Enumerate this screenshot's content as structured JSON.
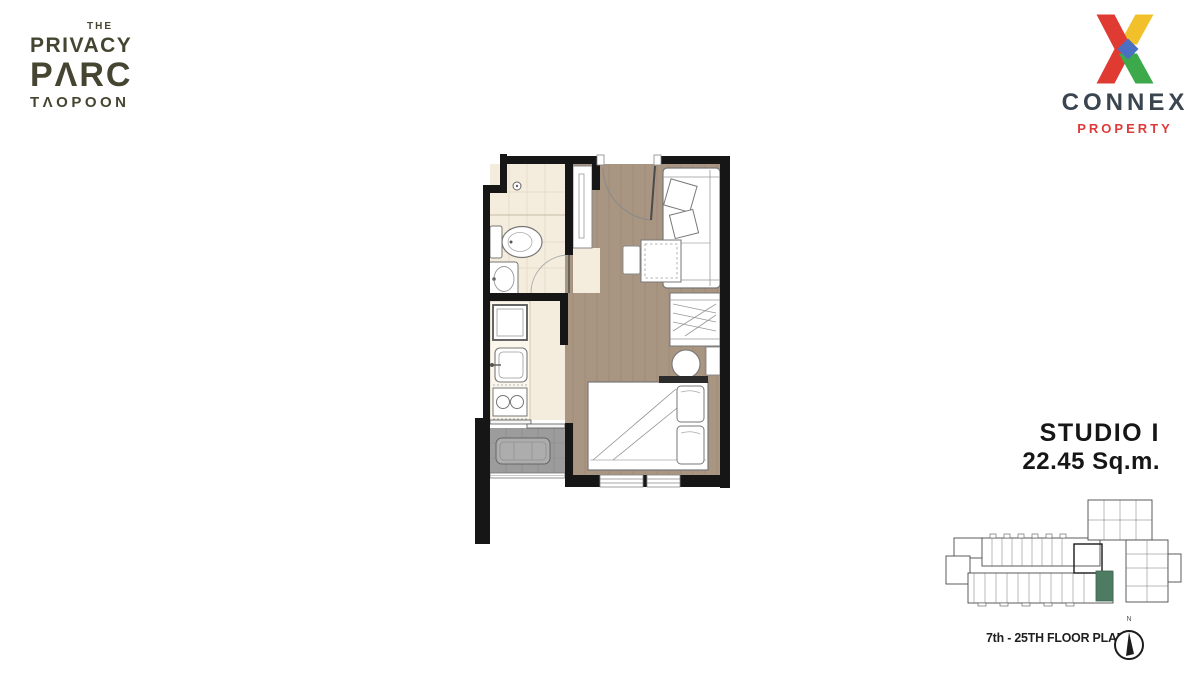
{
  "project_logo": {
    "pre": "THE",
    "line1": "PRIVACY",
    "line2": "PΛRC",
    "line3": "TΛOPOON",
    "color": "#454531"
  },
  "agency_logo": {
    "name": "CONNEX",
    "division": "PROPERTY",
    "name_color": "#3a4550",
    "division_color": "#dd3b3a",
    "x_colors": {
      "red": "#df3b33",
      "yellow": "#f2c02b",
      "green": "#3ca94b",
      "blue": "#4a6fc3"
    }
  },
  "unit": {
    "type": "STUDIO I",
    "area": "22.45 Sq.m."
  },
  "key_plan": {
    "caption": "7th - 25TH FLOOR PLAN",
    "north_label": "N",
    "highlight_color": "#4d7c62"
  },
  "plan_colors": {
    "wall": "#161616",
    "wood_floor": "#a89582",
    "tile_floor": "#f4ecdc",
    "counter": "#fbf7ed",
    "balcony_floor": "#9c9c9c"
  }
}
